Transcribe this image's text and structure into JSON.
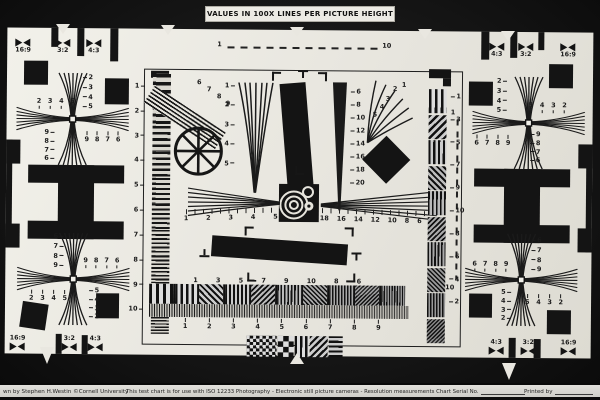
{
  "title": "VALUES IN 100X LINES PER PICTURE HEIGHT",
  "footer": {
    "credit": "wn by Stephen H.Westin   ©Cornell University",
    "usage": "This test chart is for use with ISO 12233 Photography - Electronic still picture cameras - Resolution measurements Chart Serial No.",
    "printed_by": "Printed by"
  },
  "rulers": {
    "top_start": "1",
    "top_end": "10",
    "right_start": "1",
    "right_end": "10"
  },
  "aspect_markers": {
    "top_left": [
      "16:9",
      "3:2",
      "4:3"
    ],
    "top_right": [
      "4:3",
      "3:2",
      "16:9"
    ],
    "bottom_left": [
      "16:9",
      "3:2",
      "4:3"
    ],
    "bottom_right": [
      "4:3",
      "3:2",
      "16:9"
    ]
  },
  "scales": {
    "left_column": [
      1,
      2,
      3,
      4,
      5,
      6,
      7,
      8,
      9,
      10
    ],
    "slant_sweep": [
      6,
      7,
      8,
      9
    ],
    "center_wedge_left": [
      1,
      2,
      3,
      4,
      5
    ],
    "center_wedge_right": [
      6,
      8,
      10,
      12,
      14,
      16,
      18,
      20
    ],
    "fan_burst": [
      1,
      2,
      3,
      4,
      5
    ],
    "hwedge_left": [
      1,
      2,
      3,
      4,
      5
    ],
    "hwedge_right": [
      18,
      16,
      14,
      12,
      10,
      8,
      6
    ],
    "sweep_top": [
      1,
      3,
      5,
      7,
      9,
      10,
      8,
      6
    ],
    "sweep_bottom": [
      1,
      2,
      3,
      4,
      5,
      6,
      7,
      8,
      9
    ],
    "right_blocks": [
      1,
      3,
      5,
      7,
      9,
      10,
      8,
      6,
      4,
      2
    ]
  },
  "crosses": {
    "tl": {
      "row_outer": [
        2,
        3,
        4,
        5
      ],
      "col_outer": [
        2,
        3,
        4,
        5
      ],
      "col_inner": [
        9,
        8,
        7,
        6
      ],
      "row_inner": [
        9,
        8,
        7,
        6
      ]
    },
    "tr": {
      "row_outer": [
        5,
        4,
        3,
        2
      ],
      "col_outer": [
        2,
        3,
        4,
        5
      ],
      "col_inner": [
        9,
        8,
        7,
        6
      ],
      "row_inner": [
        6,
        7,
        8,
        9
      ]
    },
    "bl": {
      "row_outer": [
        2,
        3,
        4,
        5
      ],
      "col_outer": [
        6,
        7,
        8,
        9
      ],
      "col_inner": [
        5,
        4,
        3,
        2
      ],
      "row_inner": [
        9,
        8,
        7,
        6
      ]
    },
    "br": {
      "row_outer": [
        5,
        4,
        3,
        2
      ],
      "col_outer": [
        6,
        7,
        8,
        9
      ],
      "col_inner": [
        5,
        4,
        3,
        2
      ],
      "row_inner": [
        6,
        7,
        8,
        9
      ]
    }
  },
  "colors": {
    "paper": "#e9e7e0",
    "ink": "#161616",
    "background": "#101010",
    "footer_bg": "#d8d7d2"
  }
}
